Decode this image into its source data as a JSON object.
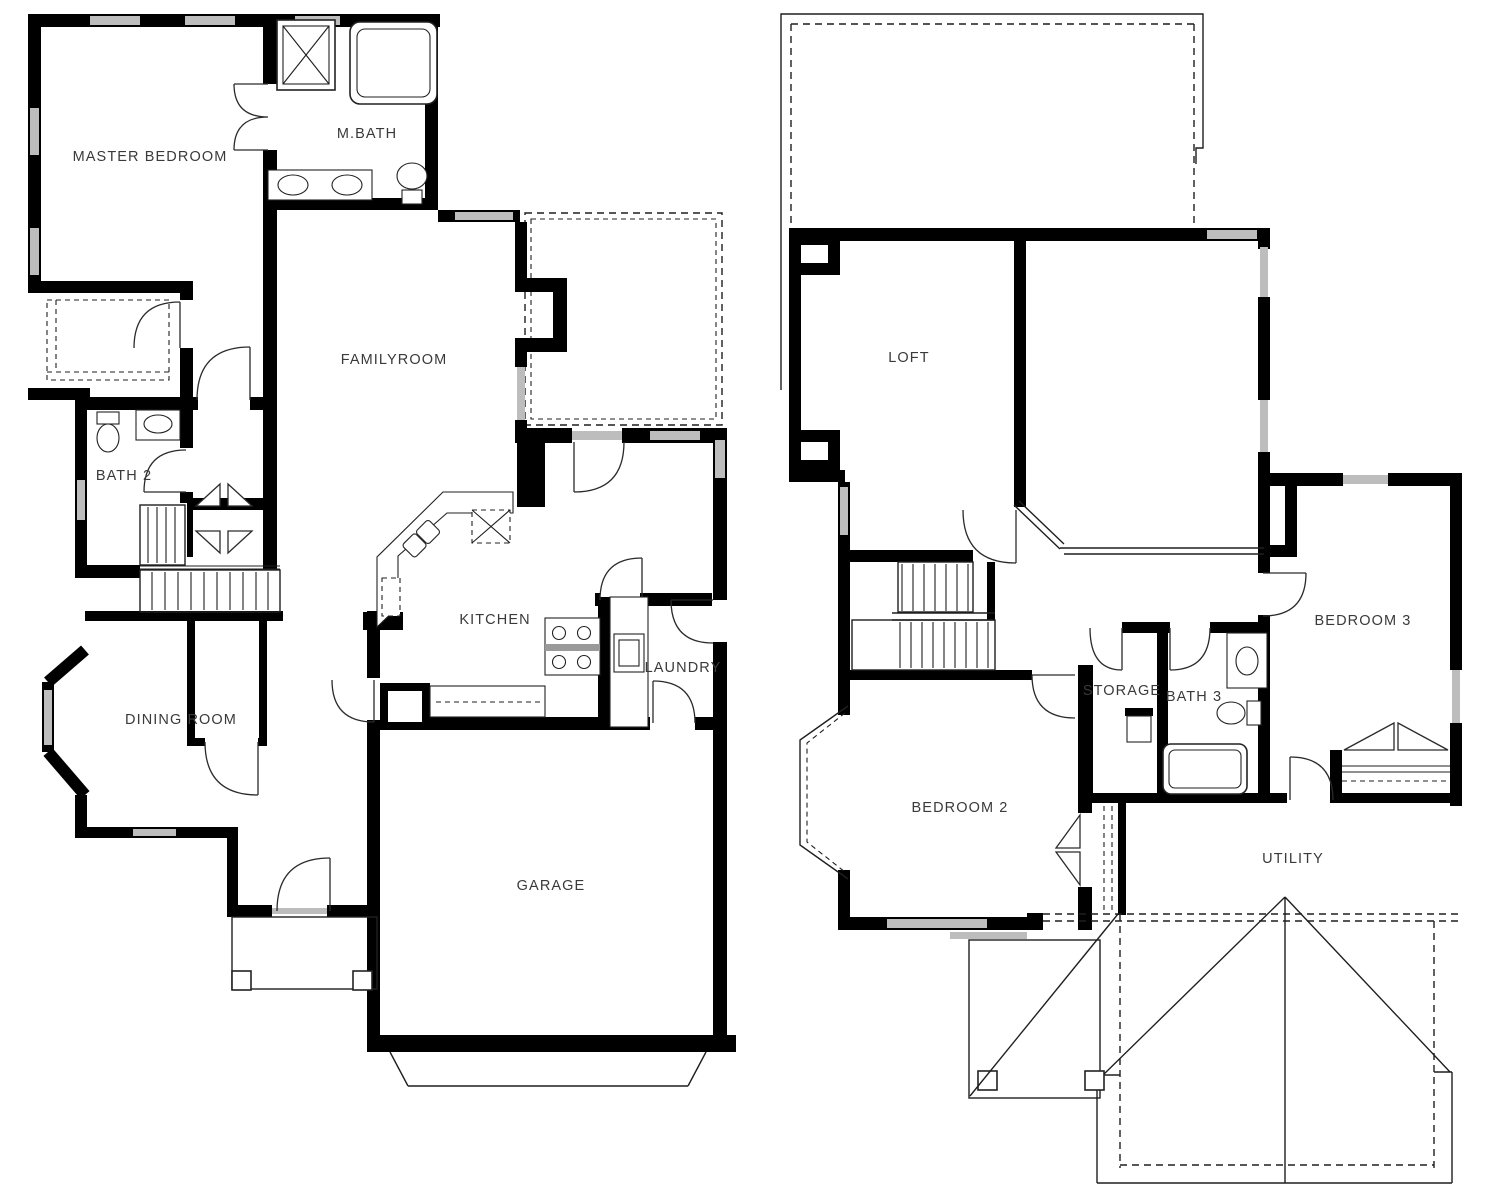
{
  "colors": {
    "wall": "#000000",
    "window": "#bdbdbd",
    "line": "#1f1f1f",
    "label": "#3a3a3a",
    "background": "#ffffff"
  },
  "first_floor": {
    "labels": {
      "master_bedroom": "MASTER BEDROOM",
      "m_bath": "M.BATH",
      "familyroom": "FAMILYROOM",
      "bath_2": "BATH 2",
      "kitchen": "KITCHEN",
      "laundry": "LAUNDRY",
      "dining_room": "DINING ROOM",
      "garage": "GARAGE"
    }
  },
  "second_floor": {
    "labels": {
      "loft": "LOFT",
      "bedroom_3": "BEDROOM 3",
      "storage": "STORAGE",
      "bath_3": "BATH 3",
      "bedroom_2": "BEDROOM 2",
      "utility": "UTILITY"
    }
  }
}
